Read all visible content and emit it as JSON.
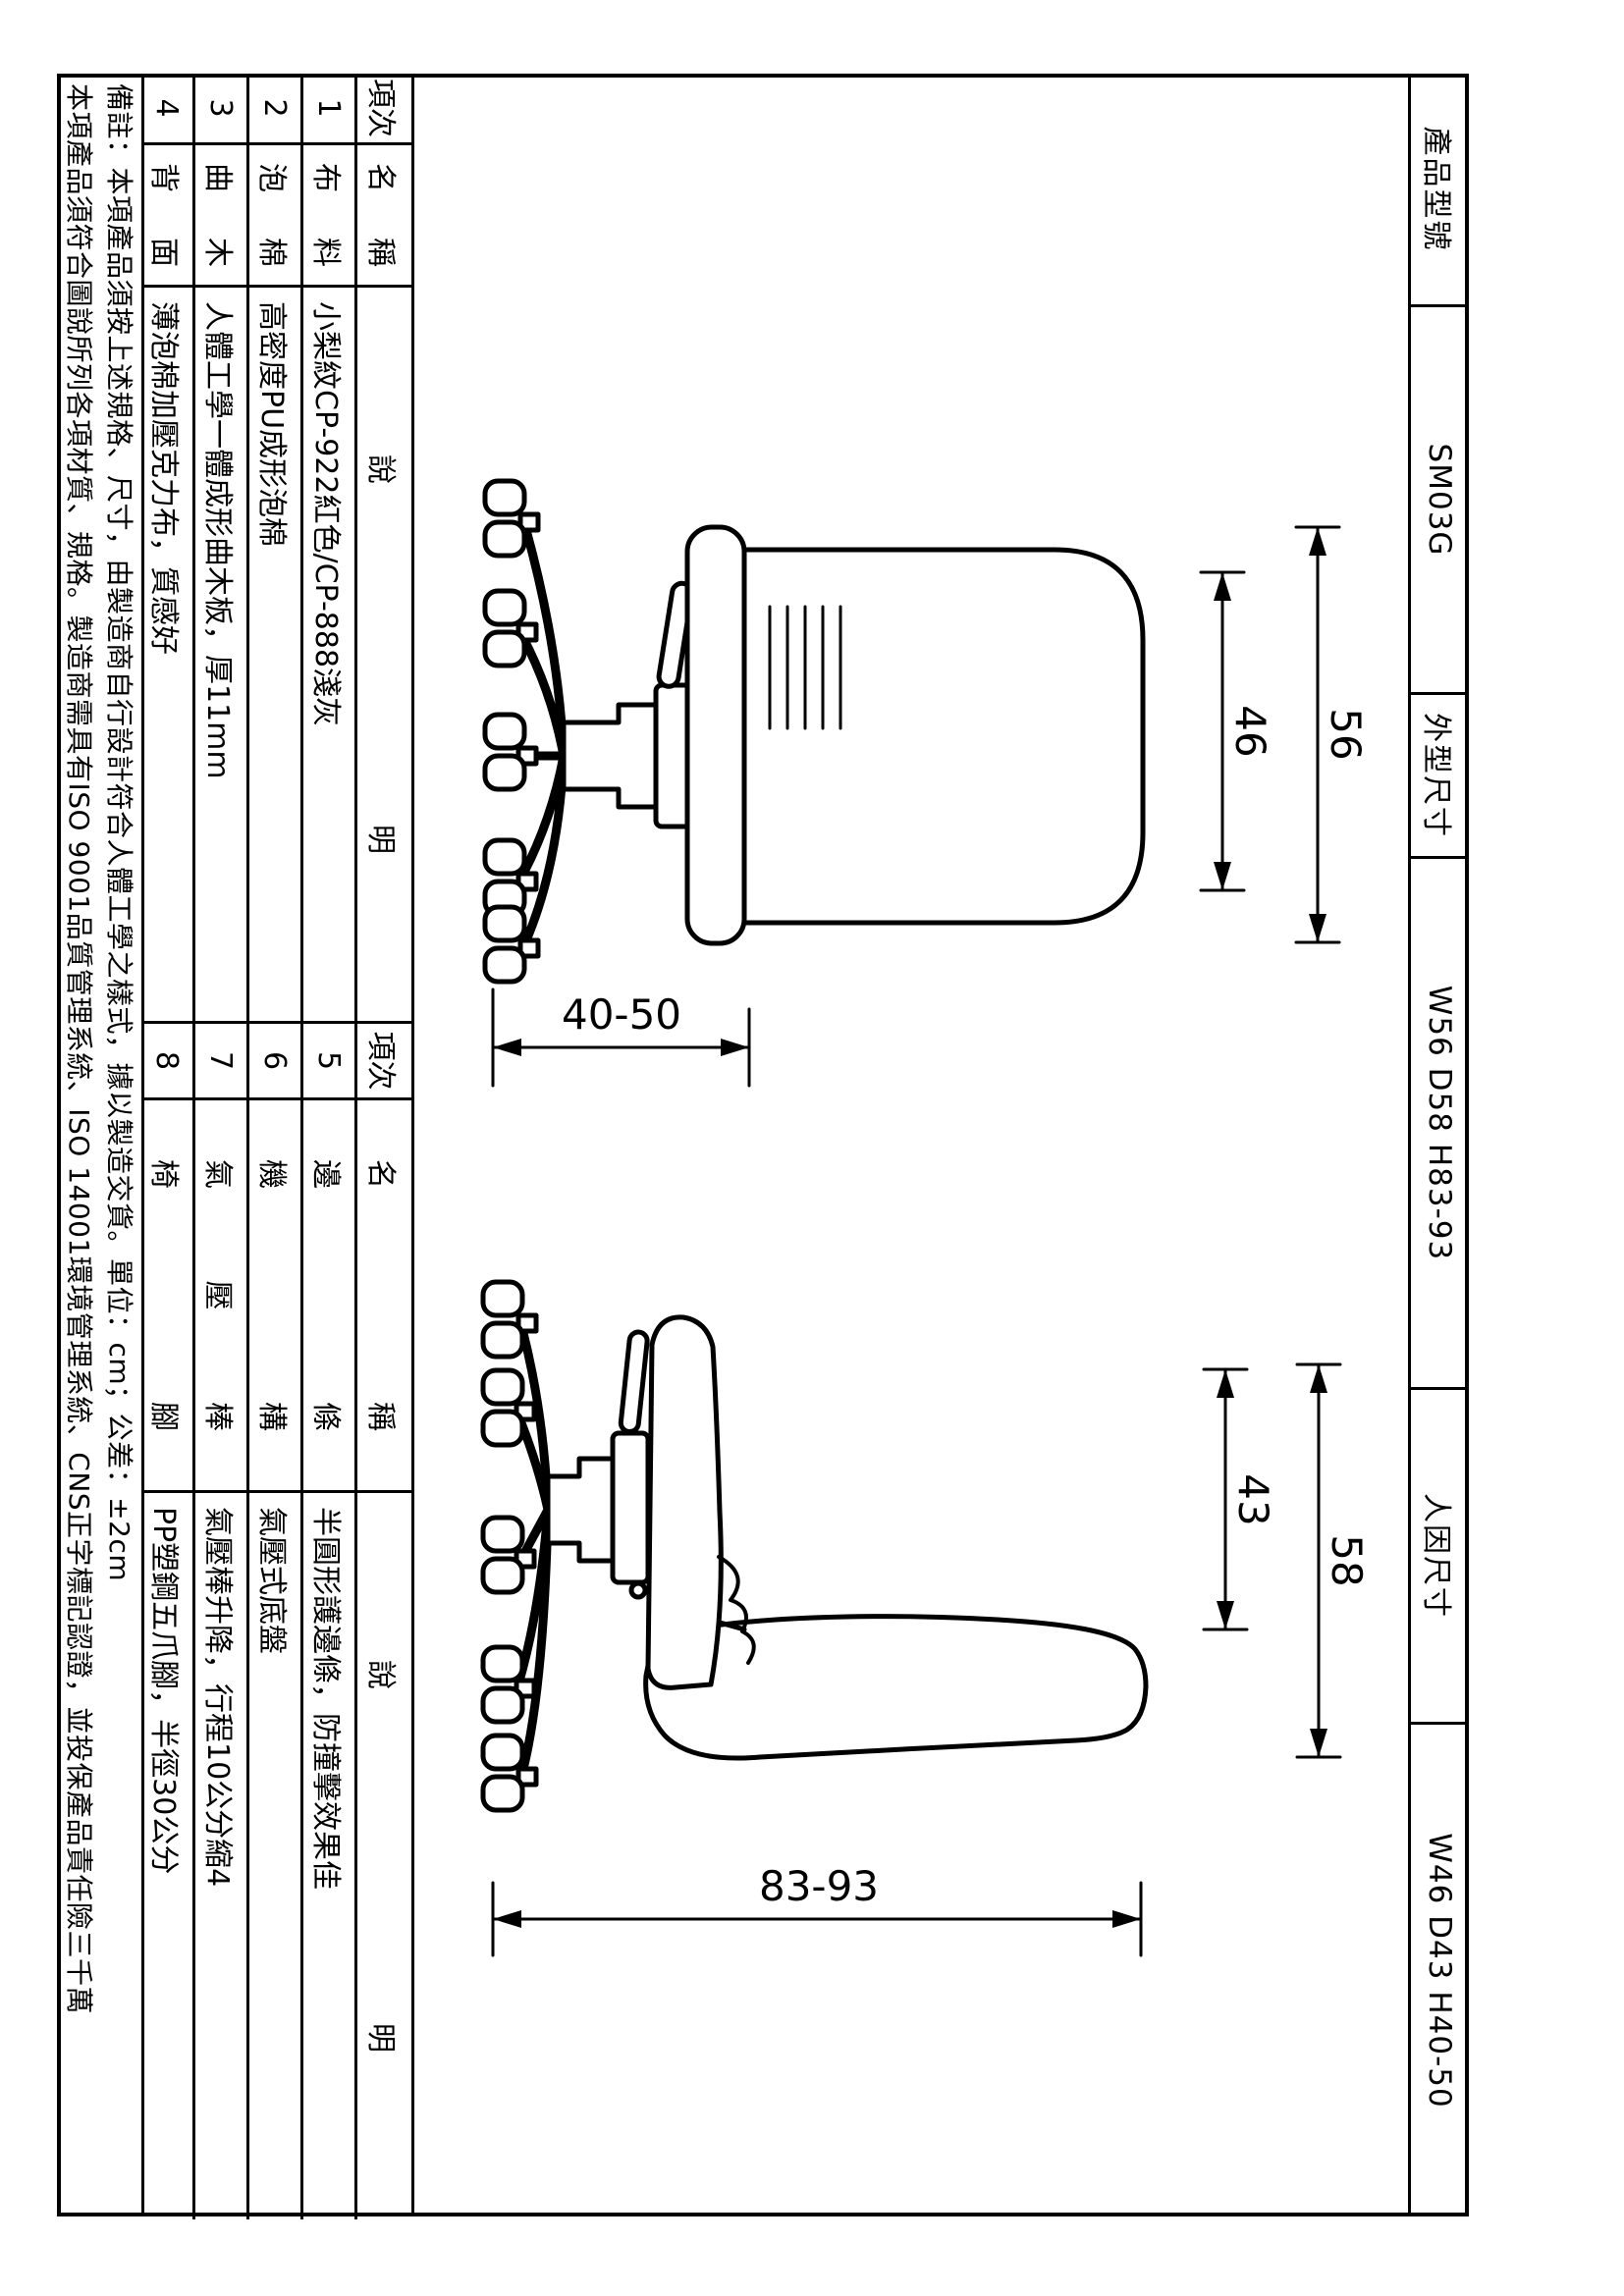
{
  "title_block": {
    "product_model_label": "產品型號",
    "product_model_value": "SM03G",
    "overall_size_label": "外型尺寸",
    "overall_size_value": "W56 D58 H83-93",
    "ergonomic_size_label": "人因尺寸",
    "ergonomic_size_value": "W46 D43 H40-50"
  },
  "spec_table_left": {
    "col_no": "項次",
    "col_name": "名稱",
    "col_desc": "說明",
    "rows": [
      {
        "no": "1",
        "name": "布料",
        "desc": "小梨紋CP-922紅色/CP-888淺灰"
      },
      {
        "no": "2",
        "name": "泡棉",
        "desc": "高密度PU成形泡棉"
      },
      {
        "no": "3",
        "name": "曲木",
        "desc": "人體工學一體成形曲木板，厚11mm"
      },
      {
        "no": "4",
        "name": "背面",
        "desc": "薄泡棉加壓克力布，質感好"
      }
    ]
  },
  "spec_table_right": {
    "col_no": "項次",
    "col_name": "名稱",
    "col_desc": "說明",
    "rows": [
      {
        "no": "5",
        "name": "邊條",
        "desc": "半圓形護邊條，防撞擊效果佳"
      },
      {
        "no": "6",
        "name": "機構",
        "desc": "氣壓式底盤"
      },
      {
        "no": "7",
        "name": "氣壓棒",
        "desc": "氣壓棒升降，行程10公分縮4"
      },
      {
        "no": "8",
        "name": "椅腳",
        "desc": "PP塑鋼五爪腳，半徑30公分"
      }
    ]
  },
  "notes": {
    "line1": "備註：本項產品須按上述規格、尺寸，由製造商自行設計符合人體工學之樣式，據以製造交貨。單位：cm；公差：±2cm",
    "line2": "本項產品須符合圖說所列各項材質、規格。製造商需具有ISO 9001品質管理系統、ISO 14001環境管理系統、CNS正字標記認證，並投保產品責任險三千萬"
  },
  "dimensions": {
    "front_overall_width": "56",
    "front_seat_width": "46",
    "front_seat_height": "40-50",
    "side_overall_depth": "58",
    "side_seat_depth": "43",
    "side_overall_height": "83-93"
  }
}
